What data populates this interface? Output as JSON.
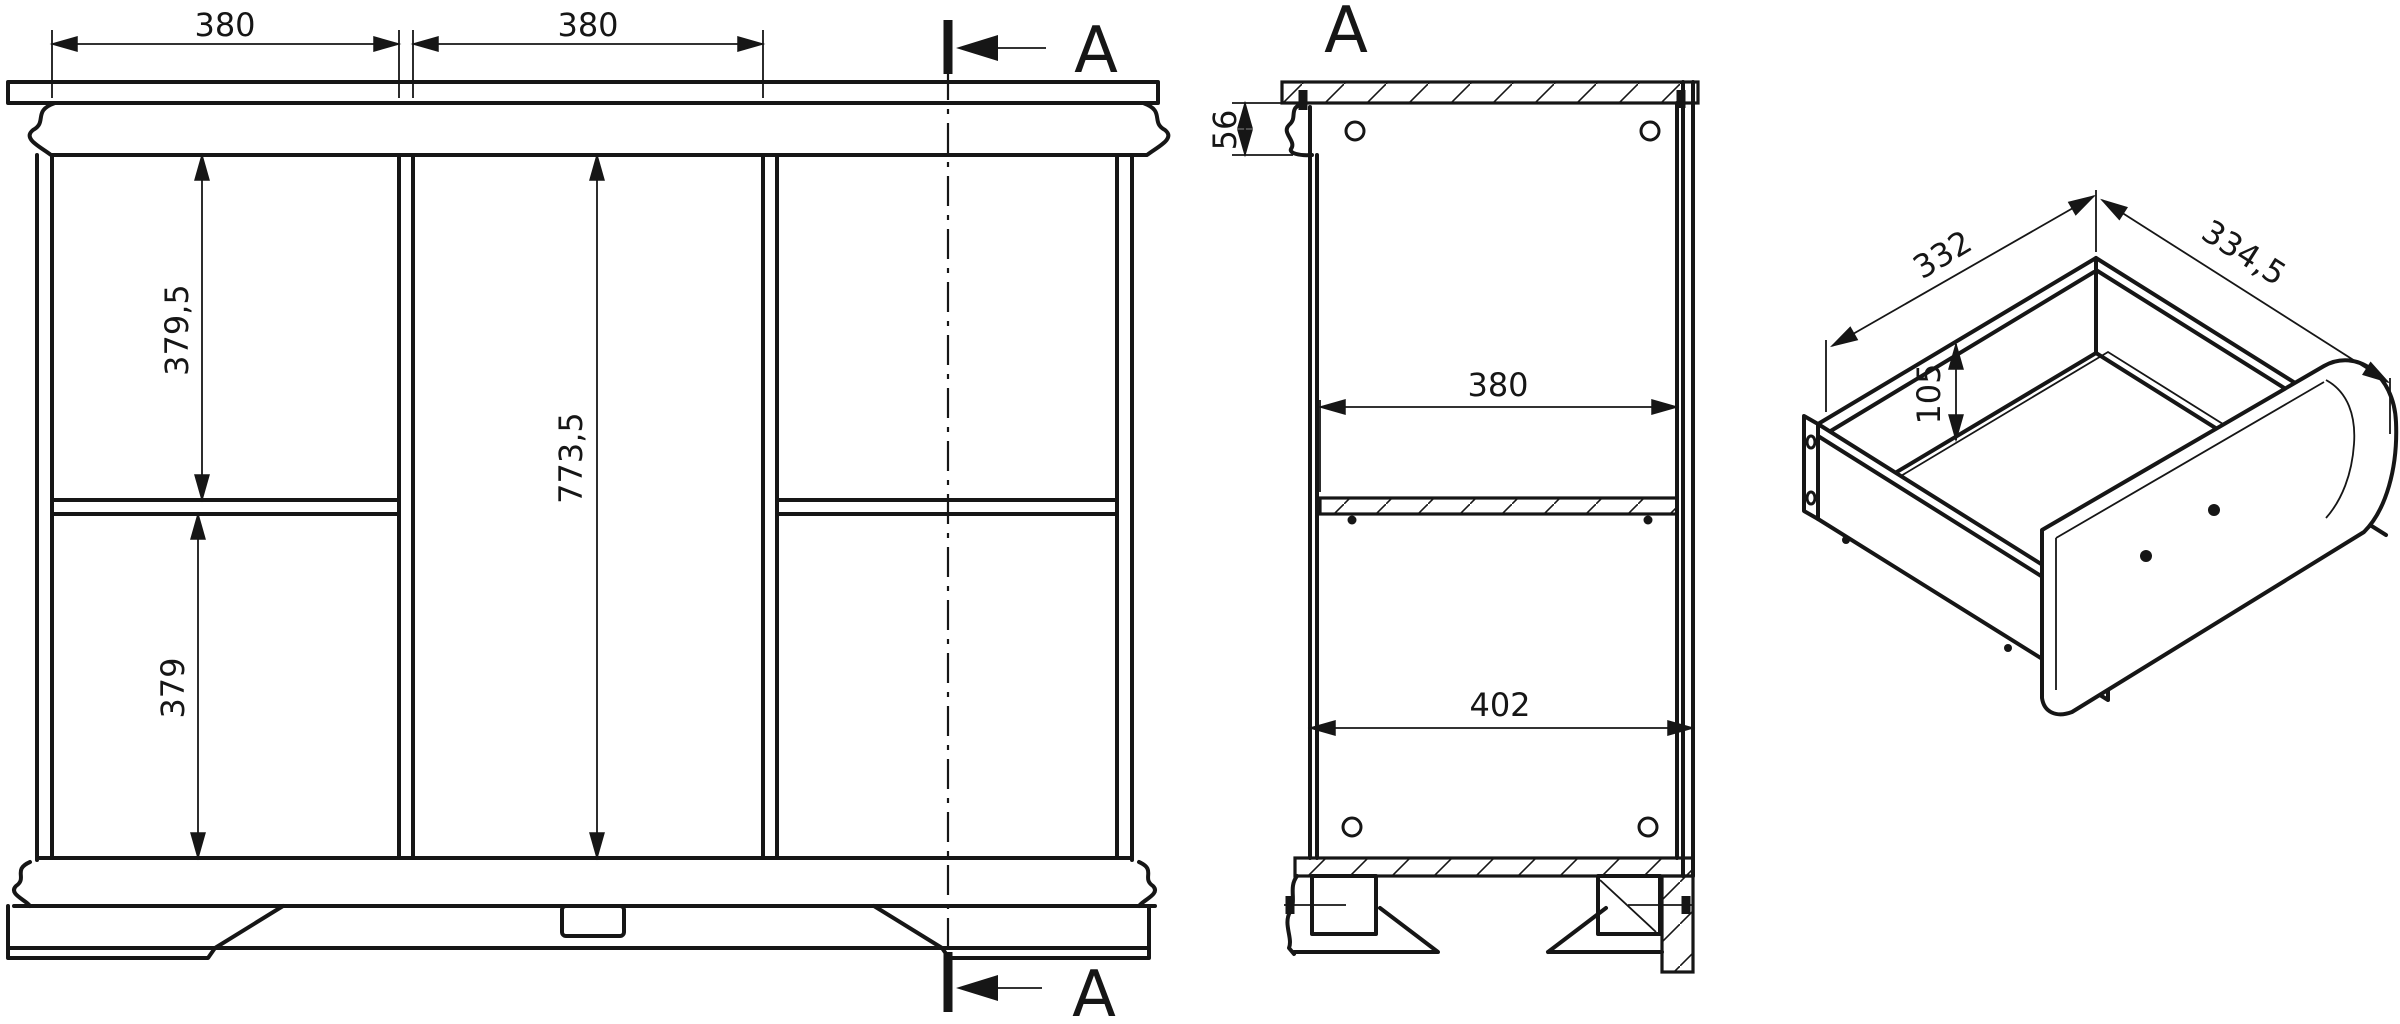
{
  "page": {
    "background": "#ffffff",
    "line_color": "#161616",
    "kind": "furniture technical drawing"
  },
  "front_view": {
    "dims": {
      "width_left": "380",
      "width_right": "380",
      "height_upper_left": "379,5",
      "height_center": "773,5",
      "height_lower_left": "379"
    },
    "section": {
      "top_label": "A",
      "bottom_label": "A"
    }
  },
  "section_view": {
    "label": "A",
    "dims": {
      "crown_height": "56",
      "interior_depth": "380",
      "base_depth": "402"
    }
  },
  "drawer_view": {
    "dims": {
      "width": "332",
      "depth": "334,5",
      "height": "105"
    }
  }
}
